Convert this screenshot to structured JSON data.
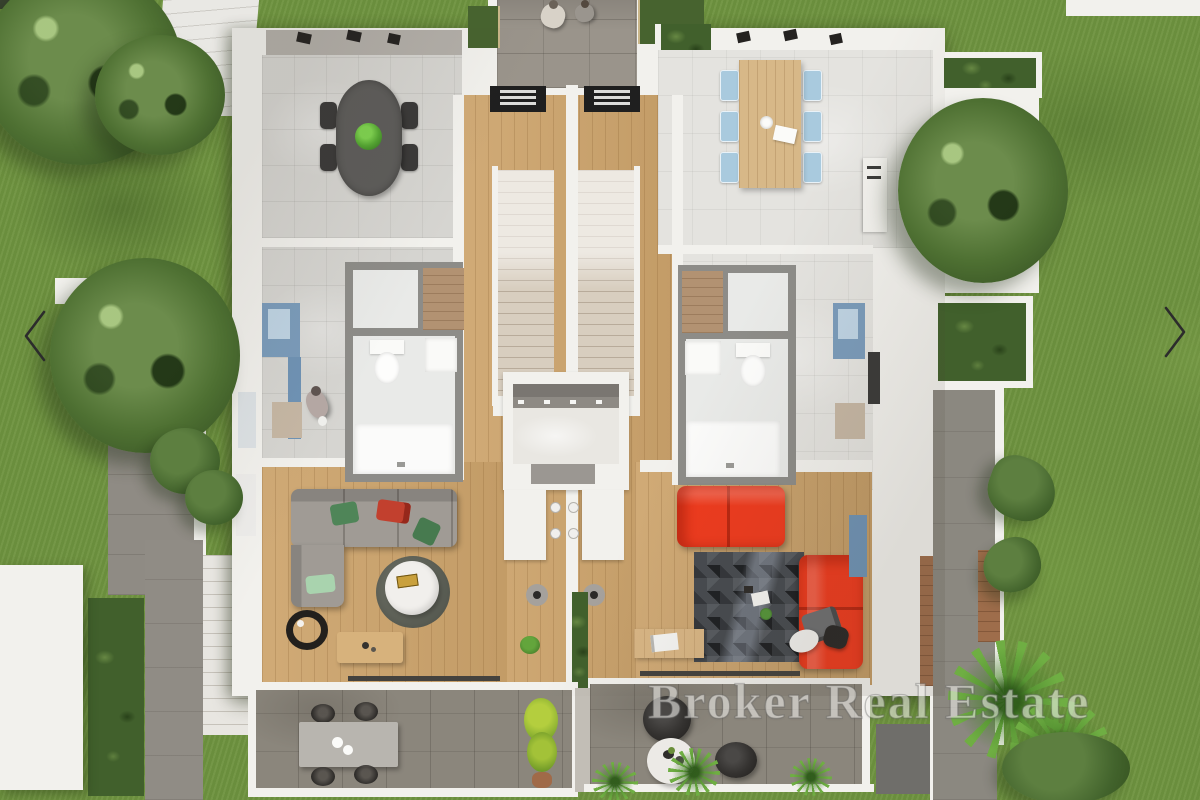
{
  "viewer": {
    "watermark_text": "Broker Real Estate",
    "nav": {
      "prev_icon": "chevron-left-icon",
      "next_icon": "chevron-right-icon"
    }
  },
  "scene": {
    "colors": {
      "grass": "#6f9340",
      "foliage": "#4e7032",
      "wall": "#f2f1ed",
      "paver": "#9a948b",
      "terracePaver": "#8b867c",
      "tileLeft": "#d6d5d1",
      "tileRight": "#e4e3df",
      "wood": "#cda46c",
      "stairCarpet": "#d8cebf",
      "sofaGray": "#a09b95",
      "sofaRed": "#ee3b1e",
      "chairBlue": "#a9cade",
      "diningTableDark": "#5d5c5a",
      "diningTableWood": "#d7b888",
      "rugDark": "#474b50",
      "pillowGreen": "#4f8558",
      "pillowRed": "#c2402e",
      "windowBlue": "#7b9cbb",
      "hedge": "#41602c",
      "plantBright": "#55a832",
      "plantYellow": "#b4ce3e",
      "potTerracotta": "#a06a48",
      "watermark": "#efeeea"
    }
  }
}
